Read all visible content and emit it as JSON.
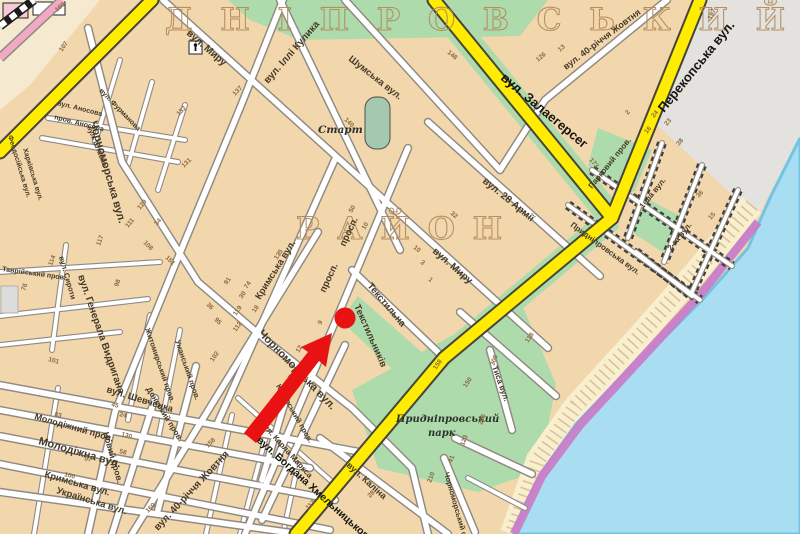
{
  "map": {
    "district_top": "Д Н І П Р О В С Ь К И Й",
    "district_mid": "Р А Й О Н",
    "colors": {
      "land": "#f2d6ac",
      "street": "#ffffff",
      "major_road": "#ffec00",
      "green_area": "#aedbab",
      "water": "#a8ddf2",
      "embankment": "#c87ec8",
      "beach": "#f8efcf",
      "industrial": "#e4e2df",
      "railway_road": "#f2aac4",
      "marker": "#e81212",
      "district_text": "#b28b5e"
    },
    "labels": [
      {
        "text": "вул. Миру",
        "x": 186,
        "y": 34,
        "rot": 41,
        "size": 10,
        "cls": "st"
      },
      {
        "text": "вул. Миру",
        "x": 432,
        "y": 252,
        "rot": 41,
        "size": 10,
        "cls": "st"
      },
      {
        "text": "вул. Іллі Кулика",
        "x": 268,
        "y": 84,
        "rot": -49,
        "size": 10,
        "cls": "st"
      },
      {
        "text": "Шумська вул.",
        "x": 348,
        "y": 60,
        "rot": 38,
        "size": 9.5,
        "cls": "st"
      },
      {
        "text": "вул. 40-річчя Жовтня",
        "x": 566,
        "y": 70,
        "rot": -37,
        "size": 9,
        "cls": "st"
      },
      {
        "text": "вул. 28 Армії",
        "x": 482,
        "y": 182,
        "rot": 39,
        "size": 10,
        "cls": "st"
      },
      {
        "text": "Чорноморська вул.",
        "x": 90,
        "y": 122,
        "rot": 74,
        "size": 11,
        "cls": "st"
      },
      {
        "text": "Чорноморська вул.",
        "x": 258,
        "y": 334,
        "rot": 46,
        "size": 11,
        "cls": "st"
      },
      {
        "text": "Кримська вул.",
        "x": 260,
        "y": 300,
        "rot": -58,
        "size": 9.5,
        "cls": "st"
      },
      {
        "text": "Кримська вул.",
        "x": 44,
        "y": 477,
        "rot": 16,
        "size": 9.5,
        "cls": "st"
      },
      {
        "text": "просп.",
        "x": 325,
        "y": 293,
        "rot": -65,
        "size": 9.5,
        "cls": "st"
      },
      {
        "text": "просп.",
        "x": 345,
        "y": 247,
        "rot": -65,
        "size": 9.5,
        "cls": "st"
      },
      {
        "text": "Текстильників",
        "x": 354,
        "y": 306,
        "rot": 66,
        "size": 9.5,
        "cls": "st"
      },
      {
        "text": "Текстильна",
        "x": 367,
        "y": 286,
        "rot": 50,
        "size": 9.5,
        "cls": "st"
      },
      {
        "text": "вул. Генерала Видригана",
        "x": 78,
        "y": 276,
        "rot": 71,
        "size": 10,
        "cls": "st"
      },
      {
        "text": "вул. Шевченка",
        "x": 106,
        "y": 392,
        "rot": 17,
        "size": 9.5,
        "cls": "st"
      },
      {
        "text": "Молодіжний пров.",
        "x": 34,
        "y": 419,
        "rot": 16,
        "size": 9,
        "cls": "st"
      },
      {
        "text": "Молодіжна вул.",
        "x": 38,
        "y": 444,
        "rot": 16,
        "size": 11,
        "cls": "st"
      },
      {
        "text": "Українська вул.",
        "x": 56,
        "y": 493,
        "rot": 17,
        "size": 9.5,
        "cls": "st"
      },
      {
        "text": "Новий пров.",
        "x": 103,
        "y": 433,
        "rot": 74,
        "size": 8.5,
        "cls": "st"
      },
      {
        "text": "Донський пров.",
        "x": 146,
        "y": 389,
        "rot": 58,
        "size": 8,
        "cls": "st"
      },
      {
        "text": "вул. 40-річчя Жовтня",
        "x": 158,
        "y": 531,
        "rot": -47,
        "size": 10,
        "cls": "st"
      },
      {
        "text": "вул. Каліна",
        "x": 346,
        "y": 466,
        "rot": 42,
        "size": 9,
        "cls": "st"
      },
      {
        "text": "вул. Карла Маркса",
        "x": 260,
        "y": 424,
        "rot": 48,
        "size": 8,
        "cls": "st"
      },
      {
        "text": "Каховський пров.",
        "x": 276,
        "y": 386,
        "rot": 60,
        "size": 7.5,
        "cls": "st"
      },
      {
        "text": "пров. Аносова",
        "x": 54,
        "y": 119,
        "rot": 14,
        "size": 7,
        "cls": "st"
      },
      {
        "text": "вул. Аносова",
        "x": 57,
        "y": 105,
        "rot": 14,
        "size": 7,
        "cls": "st"
      },
      {
        "text": "вул. Штабна",
        "x": 87,
        "y": 127,
        "rot": 68,
        "size": 7,
        "cls": "st"
      },
      {
        "text": "вул. Фурманова",
        "x": 99,
        "y": 91,
        "rot": 46,
        "size": 7,
        "cls": "st"
      },
      {
        "text": "Феодосійська вул.",
        "x": 8,
        "y": 136,
        "rot": 73,
        "size": 7,
        "cls": "st"
      },
      {
        "text": "Харківська вул.",
        "x": 23,
        "y": 149,
        "rot": 73,
        "size": 7,
        "cls": "st"
      },
      {
        "text": "Таврійський пров.",
        "x": 2,
        "y": 271,
        "rot": 8,
        "size": 7,
        "cls": "st"
      },
      {
        "text": "вул. Сироти",
        "x": 59,
        "y": 257,
        "rot": 74,
        "size": 7.5,
        "cls": "st"
      },
      {
        "text": "Житомирський пров.",
        "x": 145,
        "y": 329,
        "rot": 71,
        "size": 7.5,
        "cls": "st"
      },
      {
        "text": "Уманський пров.",
        "x": 175,
        "y": 341,
        "rot": 71,
        "size": 7.5,
        "cls": "st"
      },
      {
        "text": "Парковий пров.",
        "x": 592,
        "y": 189,
        "rot": -51,
        "size": 8,
        "cls": "st"
      },
      {
        "text": "1-ша вул.",
        "x": 643,
        "y": 209,
        "rot": -51,
        "size": 8,
        "cls": "st"
      },
      {
        "text": "2-га вул.",
        "x": 671,
        "y": 251,
        "rot": -51,
        "size": 8,
        "cls": "st"
      },
      {
        "text": "Придніпровська вул.",
        "x": 570,
        "y": 226,
        "rot": 36,
        "size": 8,
        "cls": "st"
      },
      {
        "text": "Тиса вул.",
        "x": 492,
        "y": 367,
        "rot": 70,
        "size": 8,
        "cls": "st"
      },
      {
        "text": "Чорноморський спуск",
        "x": 444,
        "y": 473,
        "rot": 74,
        "size": 7.5,
        "cls": "st"
      },
      {
        "text": "вул. Залаегерсег",
        "x": 500,
        "y": 79,
        "rot": 40,
        "size": 13,
        "cls": "rd"
      },
      {
        "text": "Перекопська вул.",
        "x": 664,
        "y": 113,
        "rot": -51,
        "size": 13,
        "cls": "rd"
      },
      {
        "text": "вул. Богдана Хмельницького",
        "x": 256,
        "y": 441,
        "rot": 42,
        "size": 10.5,
        "cls": "rd"
      },
      {
        "text": "Старт",
        "x": 318,
        "y": 133,
        "rot": 0,
        "size": 10.5,
        "cls": "poi"
      },
      {
        "text": "Придніпровський",
        "x": 396,
        "y": 422,
        "rot": 0,
        "size": 10,
        "cls": "poi"
      },
      {
        "text": "парк",
        "x": 428,
        "y": 436,
        "rot": 0,
        "size": 10,
        "cls": "poi"
      }
    ],
    "house_numbers": [
      [
        "107",
        62,
        52,
        -55
      ],
      [
        "160",
        57,
        12,
        -40
      ],
      [
        "129",
        140,
        210,
        -50
      ],
      [
        "111",
        128,
        228,
        -50
      ],
      [
        "34",
        157,
        226,
        -50
      ],
      [
        "151",
        165,
        258,
        45
      ],
      [
        "108",
        143,
        243,
        45
      ],
      [
        "114",
        52,
        266,
        -70
      ],
      [
        "117",
        100,
        246,
        -70
      ],
      [
        "98",
        118,
        287,
        -70
      ],
      [
        "76",
        25,
        291,
        -70
      ],
      [
        "36",
        206,
        305,
        45
      ],
      [
        "95",
        214,
        320,
        45
      ],
      [
        "135",
        277,
        260,
        -55
      ],
      [
        "30",
        242,
        299,
        -55
      ],
      [
        "18",
        255,
        313,
        -55
      ],
      [
        "112",
        236,
        332,
        -55
      ],
      [
        "102",
        213,
        362,
        -55
      ],
      [
        "91",
        227,
        285,
        -55
      ],
      [
        "74",
        247,
        289,
        -55
      ],
      [
        "119",
        236,
        316,
        -55
      ],
      [
        "137",
        235,
        96,
        -45
      ],
      [
        "132",
        179,
        116,
        -45
      ],
      [
        "131",
        184,
        168,
        -45
      ],
      [
        "148",
        447,
        53,
        40
      ],
      [
        "140",
        344,
        120,
        45
      ],
      [
        "173",
        589,
        160,
        50
      ],
      [
        "126",
        538,
        62,
        -40
      ],
      [
        "13",
        560,
        52,
        -40
      ],
      [
        "2",
        628,
        115,
        -50
      ],
      [
        "197",
        711,
        20,
        -62
      ],
      [
        "16",
        647,
        134,
        -50
      ],
      [
        "24",
        654,
        118,
        -50
      ],
      [
        "23",
        667,
        126,
        -50
      ],
      [
        "38",
        679,
        146,
        -50
      ],
      [
        "36",
        699,
        198,
        -50
      ],
      [
        "15",
        711,
        220,
        -50
      ],
      [
        "10",
        365,
        230,
        -60
      ],
      [
        "9",
        321,
        325,
        -60
      ],
      [
        "12",
        299,
        353,
        -60
      ],
      [
        "50",
        352,
        213,
        -60
      ],
      [
        "3",
        420,
        263,
        40
      ],
      [
        "1",
        428,
        280,
        40
      ],
      [
        "32",
        450,
        214,
        40
      ],
      [
        "10",
        413,
        248,
        40
      ],
      [
        "158",
        436,
        370,
        -55
      ],
      [
        "118",
        528,
        343,
        -55
      ],
      [
        "150",
        466,
        388,
        -55
      ],
      [
        "306",
        494,
        366,
        -70
      ],
      [
        "205",
        482,
        425,
        -70
      ],
      [
        "123",
        464,
        446,
        -70
      ],
      [
        "41",
        452,
        463,
        -70
      ],
      [
        "210",
        431,
        483,
        -70
      ],
      [
        "101",
        48,
        361,
        15
      ],
      [
        "45",
        111,
        406,
        15
      ],
      [
        "24",
        119,
        416,
        15
      ],
      [
        "130",
        121,
        436,
        15
      ],
      [
        "58",
        119,
        453,
        15
      ],
      [
        "57",
        84,
        460,
        15
      ],
      [
        "100",
        64,
        476,
        15
      ],
      [
        "83",
        54,
        416,
        15
      ],
      [
        "117",
        308,
        510,
        -45
      ],
      [
        "28",
        370,
        498,
        -45
      ],
      [
        "160",
        148,
        513,
        -45
      ],
      [
        "158",
        208,
        448,
        -45
      ]
    ],
    "marker": {
      "color": "#e81212",
      "circle": {
        "x": 345,
        "y": 318,
        "r": 10.5
      },
      "arrow_points": "244,433 308,352 301,347 332,333 326,367 319,361 256,443"
    }
  }
}
